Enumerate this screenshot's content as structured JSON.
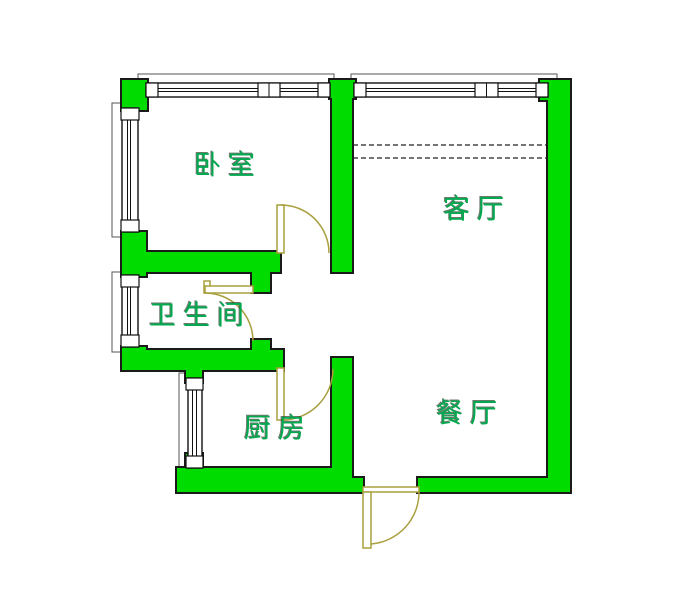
{
  "title": "apartment-floor-plan",
  "rooms": [
    {
      "id": "bedroom",
      "label": "卧室"
    },
    {
      "id": "living-room",
      "label": "客厅"
    },
    {
      "id": "bathroom",
      "label": "卫生间"
    },
    {
      "id": "kitchen",
      "label": "厨房"
    },
    {
      "id": "dining-room",
      "label": "餐厅"
    }
  ],
  "colors": {
    "background": "#ffffff",
    "wall-fill": "#00dc00",
    "wall-outline": "#1a1a1a",
    "door": "#a99f3e",
    "room-label": "#00a94f",
    "sill": "#555555",
    "window-border": "#111111"
  }
}
